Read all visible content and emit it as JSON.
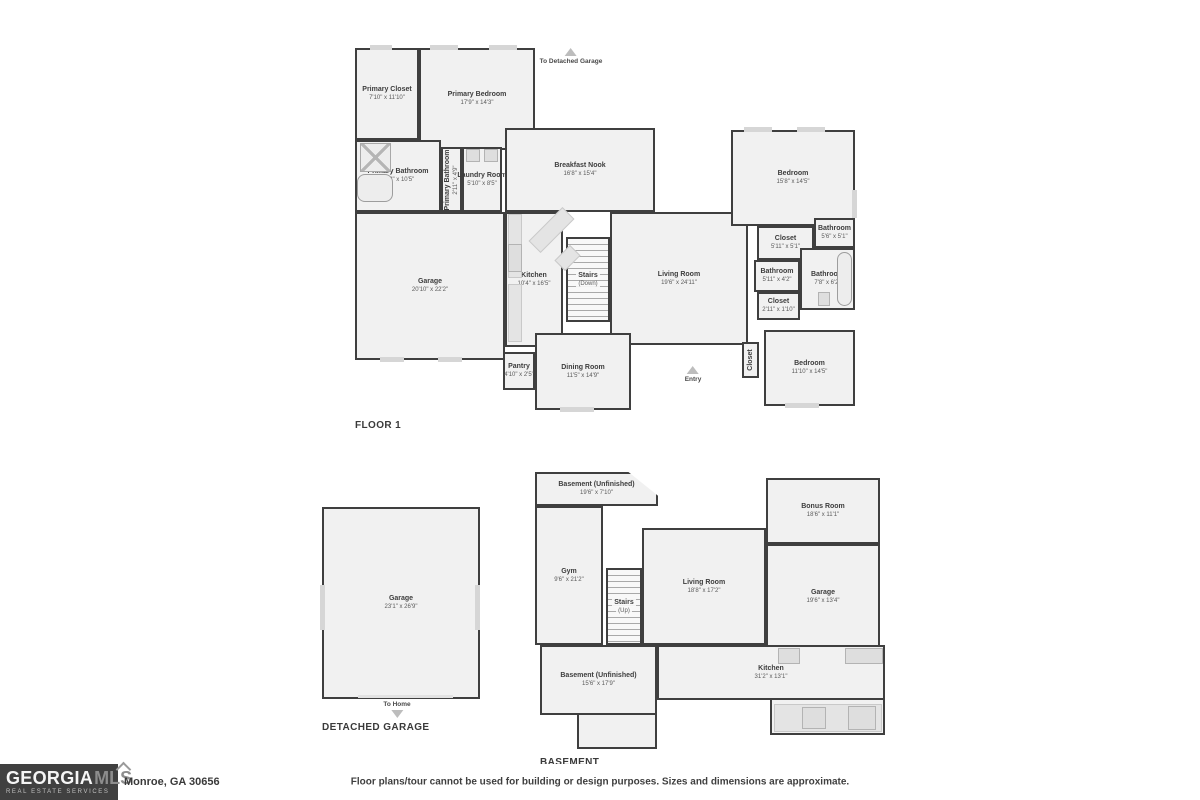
{
  "colors": {
    "wall": "#3f3f3f",
    "room_fill": "#f1f1f1",
    "window_mark": "#d6d6d6",
    "logo_bg": "#404040",
    "text_dark": "#3a3a3a",
    "arrow_gray": "#bdbdbd"
  },
  "footer": {
    "logo_text_1": "GEORGIA",
    "logo_text_2": "MLS",
    "logo_sub": "REAL ESTATE SERVICES",
    "address": "Monroe, GA 30656",
    "disclaimer": "Floor plans/tour cannot be used for building or design purposes. Sizes and dimensions are approximate."
  },
  "floors": [
    {
      "name": "FLOOR 1",
      "label_pos": {
        "x": 355,
        "y": 420
      },
      "rooms": [
        {
          "name": "Primary Closet",
          "dims": "7'10\" x 11'10\"",
          "x": 355,
          "y": 48,
          "w": 64,
          "h": 92
        },
        {
          "name": "Primary Bedroom",
          "dims": "17'9\" x 14'3\"",
          "x": 419,
          "y": 48,
          "w": 116,
          "h": 102
        },
        {
          "name": "Primary Bathroom",
          "dims": "11'2\" x 10'5\"",
          "x": 355,
          "y": 140,
          "w": 86,
          "h": 72
        },
        {
          "name": "Primary Bathroom",
          "dims": "2'11\" x 4'9\"",
          "x": 441,
          "y": 147,
          "w": 21,
          "h": 65,
          "vertical": true
        },
        {
          "name": "Laundry Room",
          "dims": "5'10\" x 8'5\"",
          "x": 462,
          "y": 147,
          "w": 40,
          "h": 65
        },
        {
          "name": "Garage",
          "dims": "20'10\" x 22'2\"",
          "x": 355,
          "y": 212,
          "w": 150,
          "h": 148
        },
        {
          "name": "Breakfast Nook",
          "dims": "16'8\" x 15'4\"",
          "x": 505,
          "y": 128,
          "w": 150,
          "h": 84
        },
        {
          "name": "Kitchen",
          "dims": "10'4\" x 16'5\"",
          "x": 505,
          "y": 212,
          "w": 58,
          "h": 135
        },
        {
          "name": "Stairs",
          "dims": "(Down)",
          "x": 566,
          "y": 237,
          "w": 44,
          "h": 85,
          "kind": "stairs"
        },
        {
          "name": "Living Room",
          "dims": "19'6\" x 24'11\"",
          "x": 610,
          "y": 212,
          "w": 138,
          "h": 133
        },
        {
          "name": "Dining Room",
          "dims": "11'5\" x 14'9\"",
          "x": 535,
          "y": 333,
          "w": 96,
          "h": 77
        },
        {
          "name": "Pantry",
          "dims": "4'10\" x 2'5\"",
          "x": 503,
          "y": 352,
          "w": 32,
          "h": 38
        },
        {
          "name": "Bedroom",
          "dims": "15'8\" x 14'5\"",
          "x": 731,
          "y": 130,
          "w": 124,
          "h": 96
        },
        {
          "name": "Closet",
          "dims": "5'11\" x 5'1\"",
          "x": 757,
          "y": 226,
          "w": 57,
          "h": 34
        },
        {
          "name": "Bathroom",
          "dims": "5'6\" x 5'1\"",
          "x": 814,
          "y": 218,
          "w": 41,
          "h": 30
        },
        {
          "name": "Bathroom",
          "dims": "5'11\" x 4'2\"",
          "x": 754,
          "y": 260,
          "w": 46,
          "h": 32
        },
        {
          "name": "Bathroom",
          "dims": "7'8\" x 6'2\"",
          "x": 800,
          "y": 248,
          "w": 55,
          "h": 62
        },
        {
          "name": "Closet",
          "dims": "2'11\" x 1'10\"",
          "x": 757,
          "y": 292,
          "w": 43,
          "h": 28
        },
        {
          "name": "Bedroom",
          "dims": "11'10\" x 14'5\"",
          "x": 764,
          "y": 330,
          "w": 91,
          "h": 76
        },
        {
          "name": "Closet",
          "dims": "",
          "x": 742,
          "y": 342,
          "w": 17,
          "h": 36,
          "vertical": true
        }
      ],
      "annotations": [
        {
          "text": "To Detached Garage",
          "x": 571,
          "y": 48,
          "arrow": "up",
          "order": "arrow-first"
        },
        {
          "text": "Entry",
          "x": 693,
          "y": 366,
          "arrow": "up",
          "order": "arrow-first"
        }
      ],
      "blocks": [
        {
          "kind": "window",
          "x": 370,
          "y": 45,
          "w": 22,
          "h": 5
        },
        {
          "kind": "window",
          "x": 430,
          "y": 45,
          "w": 28,
          "h": 5
        },
        {
          "kind": "window",
          "x": 489,
          "y": 45,
          "w": 28,
          "h": 5
        },
        {
          "kind": "window",
          "x": 744,
          "y": 127,
          "w": 28,
          "h": 5
        },
        {
          "kind": "window",
          "x": 797,
          "y": 127,
          "w": 28,
          "h": 5
        },
        {
          "kind": "window",
          "x": 852,
          "y": 190,
          "w": 5,
          "h": 28
        },
        {
          "kind": "window",
          "x": 785,
          "y": 403,
          "w": 34,
          "h": 5
        },
        {
          "kind": "window",
          "x": 560,
          "y": 407,
          "w": 34,
          "h": 5
        },
        {
          "kind": "window",
          "x": 380,
          "y": 357,
          "w": 24,
          "h": 5
        },
        {
          "kind": "window",
          "x": 438,
          "y": 357,
          "w": 24,
          "h": 5
        },
        {
          "kind": "counter",
          "x": 508,
          "y": 214,
          "w": 14,
          "h": 64
        },
        {
          "kind": "appliance",
          "x": 508,
          "y": 244,
          "w": 14,
          "h": 28
        },
        {
          "kind": "counter",
          "x": 508,
          "y": 284,
          "w": 14,
          "h": 58
        },
        {
          "kind": "island",
          "x": 543,
          "y": 206,
          "w": 17,
          "h": 48,
          "rot": 45
        },
        {
          "kind": "island",
          "x": 560,
          "y": 247,
          "w": 15,
          "h": 22,
          "rot": 45
        },
        {
          "kind": "shower",
          "x": 360,
          "y": 143,
          "w": 31,
          "h": 29
        },
        {
          "kind": "tub",
          "x": 357,
          "y": 174,
          "w": 36,
          "h": 28
        },
        {
          "kind": "appliance",
          "x": 466,
          "y": 149,
          "w": 14,
          "h": 13
        },
        {
          "kind": "appliance",
          "x": 484,
          "y": 149,
          "w": 14,
          "h": 13
        },
        {
          "kind": "tub",
          "x": 837,
          "y": 252,
          "w": 15,
          "h": 54
        },
        {
          "kind": "appliance",
          "x": 818,
          "y": 292,
          "w": 12,
          "h": 14
        }
      ]
    },
    {
      "name": "DETACHED GARAGE",
      "label_pos": {
        "x": 322,
        "y": 722
      },
      "rooms": [
        {
          "name": "Garage",
          "dims": "23'1\" x 26'9\"",
          "x": 322,
          "y": 507,
          "w": 158,
          "h": 192
        }
      ],
      "annotations": [
        {
          "text": "To Home",
          "x": 397,
          "y": 701,
          "arrow": "down",
          "order": "text-first"
        }
      ],
      "blocks": [
        {
          "kind": "window",
          "x": 320,
          "y": 585,
          "w": 5,
          "h": 45
        },
        {
          "kind": "window",
          "x": 475,
          "y": 585,
          "w": 5,
          "h": 45
        },
        {
          "kind": "door-line",
          "x": 358,
          "y": 695,
          "w": 95,
          "h": 3
        }
      ]
    },
    {
      "name": "BASEMENT",
      "label_pos": {
        "x": 540,
        "y": 757
      },
      "rooms": [
        {
          "name": "Basement (Unfinished)",
          "dims": "19'6\" x 7'10\"",
          "x": 535,
          "y": 472,
          "w": 123,
          "h": 34,
          "clip": "polygon(0 0, 76% 0, 100% 70%, 100% 100%, 0 100%)"
        },
        {
          "name": "Gym",
          "dims": "9'6\" x 21'2\"",
          "x": 535,
          "y": 506,
          "w": 68,
          "h": 139
        },
        {
          "name": "Stairs",
          "dims": "(Up)",
          "x": 606,
          "y": 568,
          "w": 36,
          "h": 77,
          "kind": "stairs"
        },
        {
          "name": "Living Room",
          "dims": "18'8\" x 17'2\"",
          "x": 642,
          "y": 528,
          "w": 124,
          "h": 117
        },
        {
          "name": "Bonus Room",
          "dims": "18'6\" x 11'1\"",
          "x": 766,
          "y": 478,
          "w": 114,
          "h": 66
        },
        {
          "name": "Garage",
          "dims": "19'6\" x 13'4\"",
          "x": 766,
          "y": 544,
          "w": 114,
          "h": 106
        },
        {
          "name": "Kitchen",
          "dims": "31'2\" x 13'1\"",
          "x": 657,
          "y": 645,
          "w": 228,
          "h": 55
        },
        {
          "name": "Basement (Unfinished)",
          "dims": "15'6\" x 17'9\"",
          "x": 540,
          "y": 645,
          "w": 117,
          "h": 70
        }
      ],
      "annotations": [],
      "blocks": [
        {
          "kind": "ext",
          "x": 770,
          "y": 698,
          "w": 115,
          "h": 37
        },
        {
          "kind": "ext",
          "x": 577,
          "y": 713,
          "w": 80,
          "h": 36
        },
        {
          "kind": "appliance",
          "x": 778,
          "y": 648,
          "w": 22,
          "h": 16
        },
        {
          "kind": "appliance",
          "x": 845,
          "y": 648,
          "w": 38,
          "h": 16
        },
        {
          "kind": "counter",
          "x": 774,
          "y": 704,
          "w": 108,
          "h": 28
        },
        {
          "kind": "appliance",
          "x": 848,
          "y": 706,
          "w": 28,
          "h": 24
        },
        {
          "kind": "appliance",
          "x": 802,
          "y": 707,
          "w": 24,
          "h": 22
        }
      ]
    }
  ]
}
